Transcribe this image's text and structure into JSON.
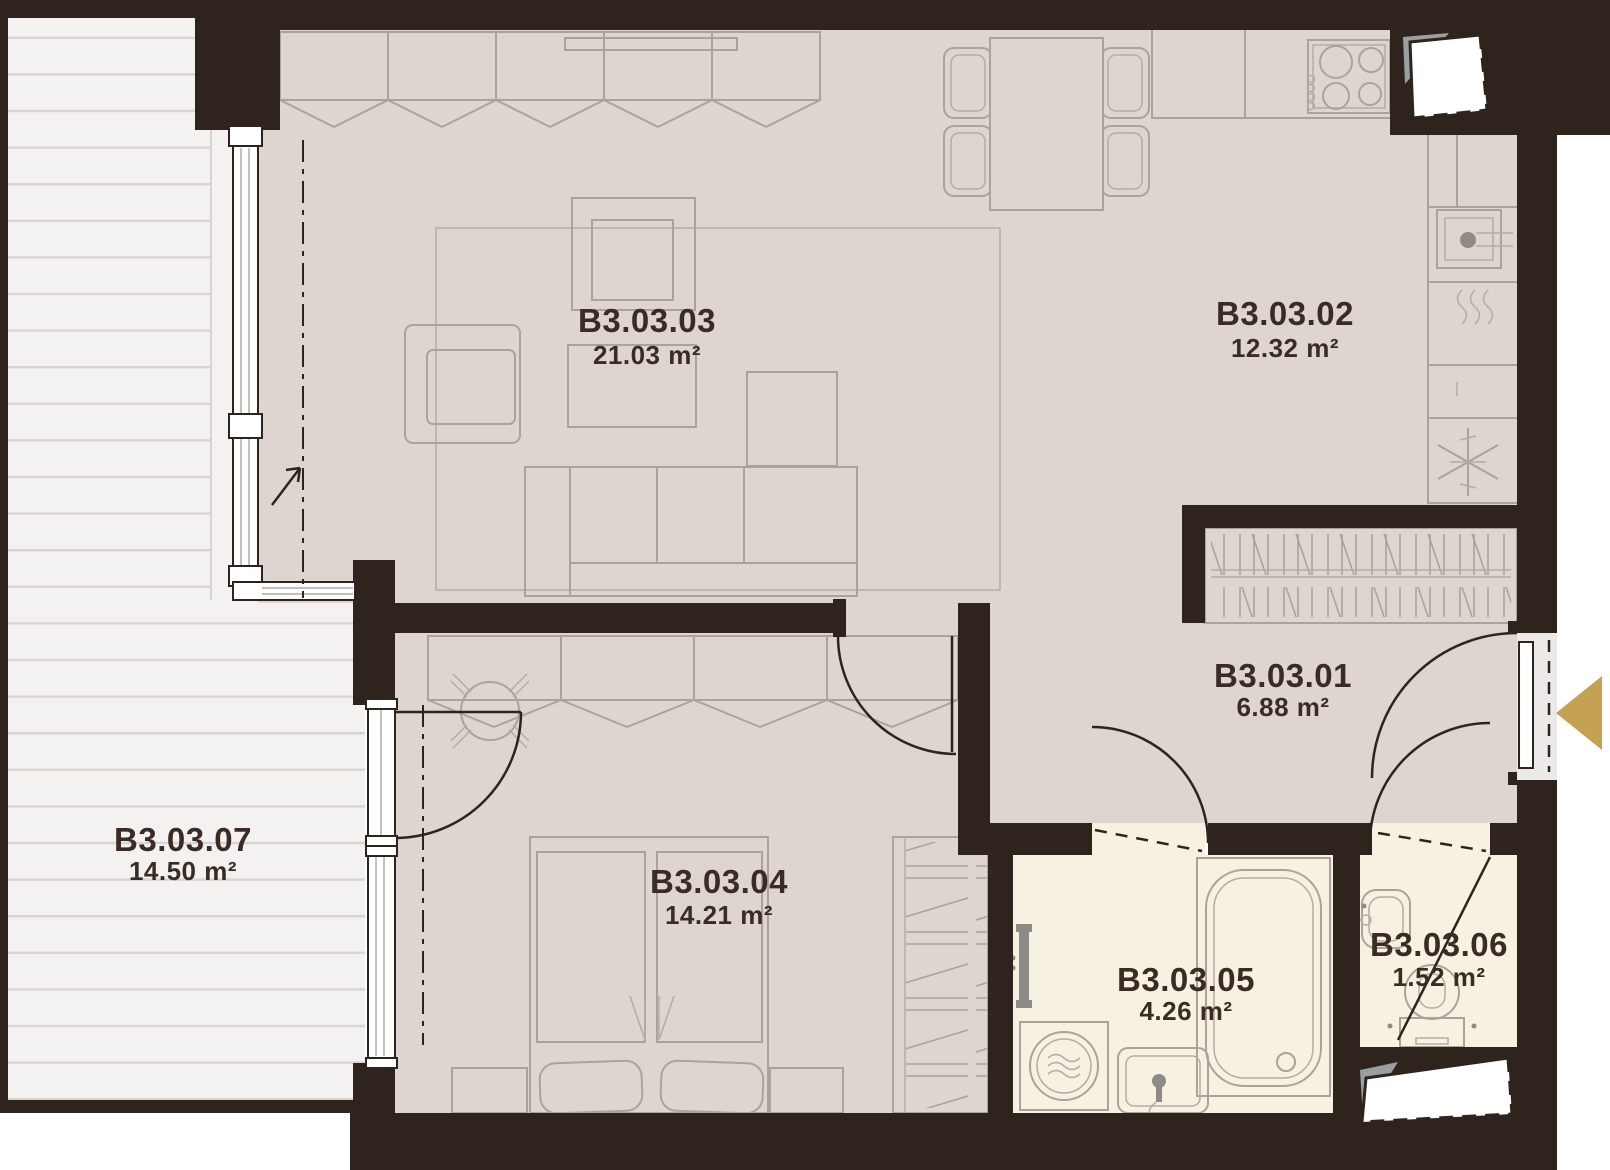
{
  "rooms": [
    {
      "id": "B3.03.01",
      "area": "6.88 m²"
    },
    {
      "id": "B3.03.02",
      "area": "12.32 m²"
    },
    {
      "id": "B3.03.03",
      "area": "21.03 m²"
    },
    {
      "id": "B3.03.04",
      "area": "14.21 m²"
    },
    {
      "id": "B3.03.05",
      "area": "4.26 m²"
    },
    {
      "id": "B3.03.06",
      "area": "1.52 m²"
    },
    {
      "id": "B3.03.07",
      "area": "14.50 m²"
    }
  ],
  "colors": {
    "wall": "#2e231d",
    "floor_main": "#ded5d0",
    "floor_wet": "#f7f1e2",
    "balcony": "#f4f2f0",
    "furniture_line": "#aba29c",
    "accent_gold": "#c5a154",
    "label_text": "#3a2c24"
  },
  "icons": {
    "entrance-arrow-icon": "◀",
    "fridge-snowflake-icon": "❄",
    "dishwasher-steam-icon": "≋",
    "washing-machine-waves-icon": "≈"
  }
}
